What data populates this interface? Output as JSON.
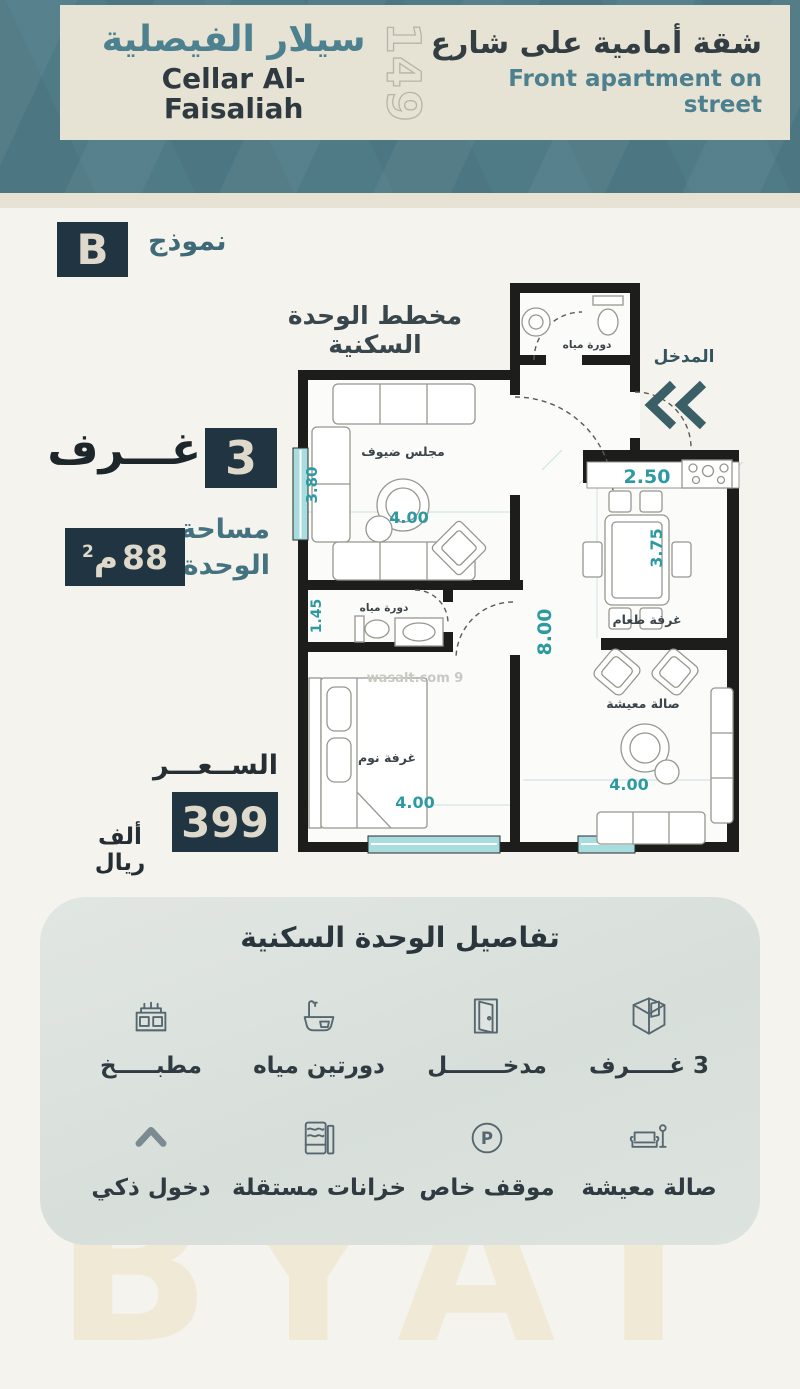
{
  "colors": {
    "band_teal": "#4f7b87",
    "panel_beige": "#e7e3d4",
    "navy": "#203442",
    "accent_teal": "#4d808e",
    "dim_teal": "#2d9aa2"
  },
  "header": {
    "title_ar": "شقة أمامية على شارع",
    "title_en": "Front apartment on street",
    "number": "149",
    "project_ar": "سيلار الفيصلية",
    "project_en": "Cellar Al-Faisaliah"
  },
  "model": {
    "letter": "B",
    "label": "نموذج"
  },
  "plan": {
    "title": "مخطط الوحدة السكنية",
    "entrance_label": "المدخل",
    "watermark": "wasalt.com 9",
    "rooms": {
      "bathroom_top": "دورة مياه",
      "guest_majlis": "مجلس ضيوف",
      "bathroom_small": "دورة مياه",
      "bedroom": "غرفة نوم",
      "dining": "غرفة طعام",
      "living": "صالة معيشة"
    },
    "dimensions": {
      "majlis_height": "3.80",
      "majlis_width": "4.00",
      "kitchen_width": "2.50",
      "dining_height": "3.75",
      "hall_height": "8.00",
      "bath_height": "1.45",
      "bedroom_width": "4.00",
      "living_width": "4.00"
    }
  },
  "stats": {
    "rooms_label": "غـــرف",
    "rooms_value": "3",
    "area_label_line1": "مساحة",
    "area_label_line2": "الوحدة",
    "area_value": "88",
    "area_unit": "م",
    "area_unit_sup": "2",
    "price_label": "الســعـــر",
    "price_value": "399",
    "price_unit": "ألف ريال"
  },
  "details": {
    "title": "تفاصيل الوحدة السكنية",
    "parking_letter": "P",
    "features": [
      {
        "icon": "rooms-cube-icon",
        "label": "3 غـــــرف"
      },
      {
        "icon": "door-icon",
        "label": "مدخـــــــل"
      },
      {
        "icon": "bathtub-icon",
        "label": "دورتين مياه"
      },
      {
        "icon": "kitchen-icon",
        "label": "مطبـــــخ"
      },
      {
        "icon": "sofa-icon",
        "label": "صالة معيشة"
      },
      {
        "icon": "parking-icon",
        "label": "موقف خاص"
      },
      {
        "icon": "tanks-icon",
        "label": "خزانات مستقلة"
      },
      {
        "icon": "smart-entry-icon",
        "label": "دخول ذكي"
      }
    ]
  },
  "watermark_text": "BYAT"
}
